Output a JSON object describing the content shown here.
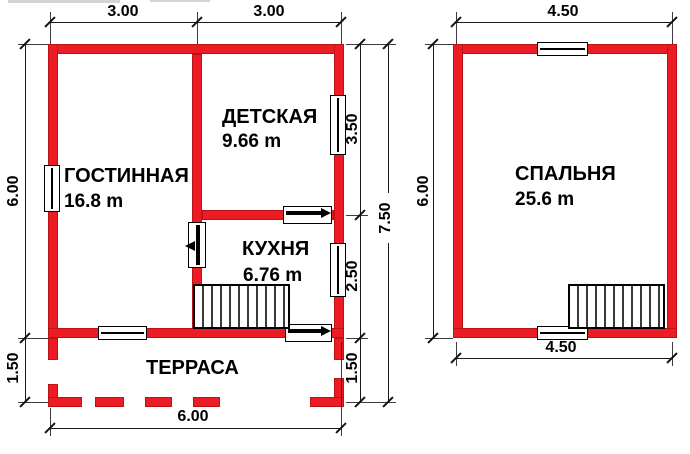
{
  "document": {
    "type": "house floor plan",
    "floors": [
      {
        "id": "floor1",
        "rooms": [
          "living",
          "children",
          "kitchen",
          "terrace"
        ]
      },
      {
        "id": "floor2",
        "rooms": [
          "bedroom"
        ]
      }
    ]
  },
  "rooms": {
    "living": {
      "name": "ГОСТИННАЯ",
      "area": "16.8 m"
    },
    "children": {
      "name": "ДЕТСКАЯ",
      "area": "9.66 m"
    },
    "kitchen": {
      "name": "КУХНЯ",
      "area": "6.76 m"
    },
    "terrace": {
      "name": "ТЕРРАСА",
      "area": ""
    },
    "bedroom": {
      "name": "СПАЛЬНЯ",
      "area": "25.6 m"
    }
  },
  "dims": {
    "f1_top_left": "3.00",
    "f1_top_right": "3.00",
    "f2_top": "4.50",
    "f1_left_main": "6.00",
    "f1_left_terrace": "1.50",
    "f1_mid_children": "3.50",
    "f1_mid_kitchen": "2.50",
    "f1_mid_terrace": "1.50",
    "f1_total_height": "7.50",
    "f2_left": "6.00",
    "f1_bottom": "6.00",
    "f2_bottom": "4.50"
  },
  "colors": {
    "wall_red": "#ed1c24",
    "dimension_line": "#1a1a1a",
    "text": "#000000",
    "background": "#ffffff"
  }
}
